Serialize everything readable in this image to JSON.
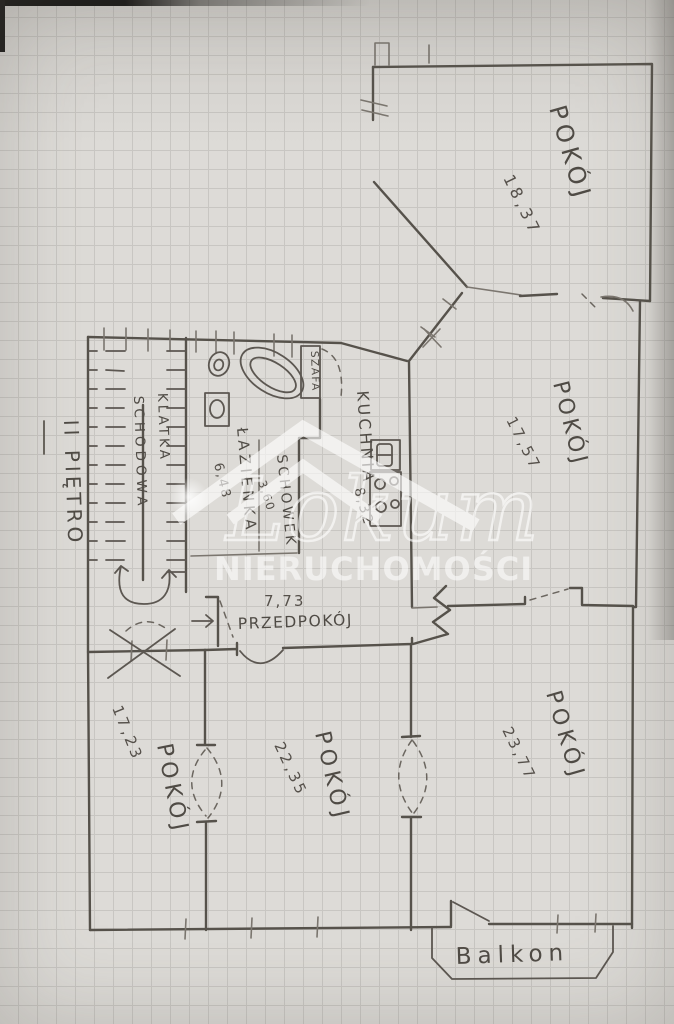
{
  "plan": {
    "floor_label": "II PIĘTRO",
    "watermark": {
      "brand": "Lokum",
      "subtitle": "NIERUCHOMOŚCI"
    },
    "rooms": {
      "top_right": {
        "name": "POKÓJ",
        "area": "18,37"
      },
      "mid_right": {
        "name": "POKÓJ",
        "area": "17,57"
      },
      "kitchen": {
        "name": "KUCHNIA",
        "area": "8,32"
      },
      "bathroom": {
        "name": "ŁAZIENKA",
        "area": "6,48"
      },
      "storage": {
        "name": "SCHOWEK",
        "area": "3,60"
      },
      "wardrobe": {
        "name": "SZAFA"
      },
      "staircase": {
        "line1": "KLATKA",
        "line2": "SCHODOWA"
      },
      "hallway": {
        "name": "PRZEDPOKÓJ",
        "area": "7,73"
      },
      "bottom_left": {
        "name": "POKÓJ",
        "area": "17,23"
      },
      "bottom_mid": {
        "name": "POKÓJ",
        "area": "22,35"
      },
      "bottom_right": {
        "name": "POKÓJ",
        "area": "23,77"
      },
      "balcony": {
        "name": "Balkon"
      }
    },
    "colors": {
      "pencil": "#56524b",
      "paper": "#dddbd7",
      "grid_line": "#c8c6c2",
      "watermark": "#ffffff"
    }
  }
}
